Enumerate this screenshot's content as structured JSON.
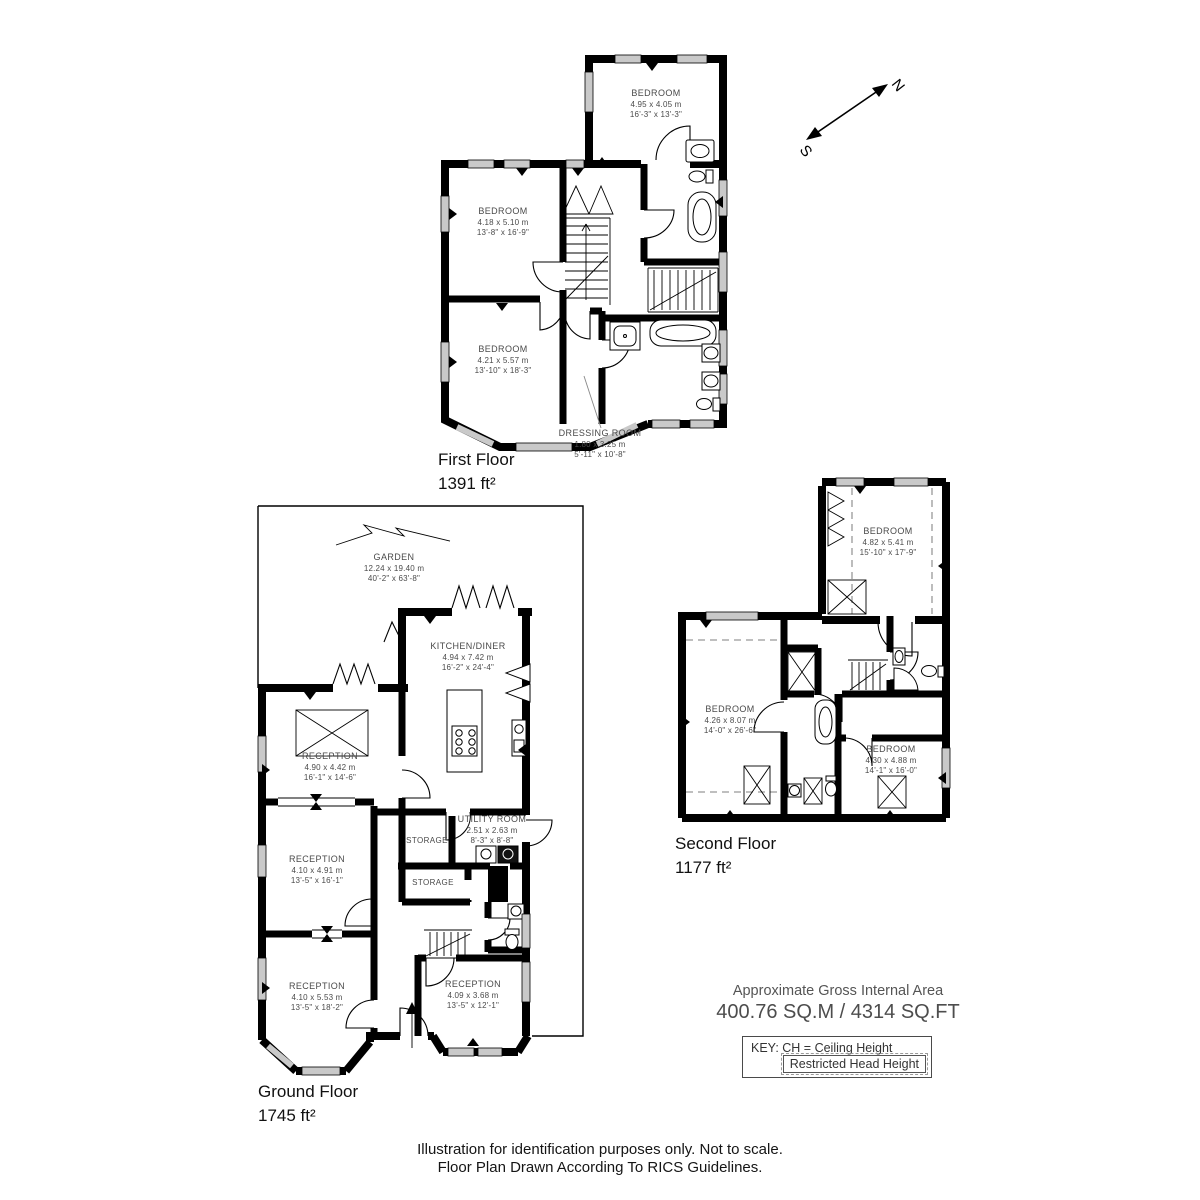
{
  "compass": {
    "north": "N",
    "south": "S"
  },
  "floors": {
    "first": {
      "title": "First Floor",
      "area": "1391 ft²",
      "rooms": {
        "bedroom_top": {
          "name": "BEDROOM",
          "metric": "4.95 x 4.05 m",
          "imperial": "16'-3\" x 13'-3\""
        },
        "bedroom_mid": {
          "name": "BEDROOM",
          "metric": "4.18 x 5.10 m",
          "imperial": "13'-8\" x 16'-9\""
        },
        "bedroom_bottom": {
          "name": "BEDROOM",
          "metric": "4.21 x 5.57 m",
          "imperial": "13'-10\" x 18'-3\""
        },
        "dressing_room": {
          "name": "DRESSING ROOM",
          "metric": "1.80 x 3.25 m",
          "imperial": "5'-11\" x 10'-8\""
        }
      }
    },
    "ground": {
      "title": "Ground Floor",
      "area": "1745 ft²",
      "rooms": {
        "garden": {
          "name": "GARDEN",
          "metric": "12.24 x 19.40 m",
          "imperial": "40'-2\" x 63'-8\""
        },
        "kitchen": {
          "name": "KITCHEN/DINER",
          "metric": "4.94 x 7.42 m",
          "imperial": "16'-2\" x 24'-4\""
        },
        "reception_rear": {
          "name": "RECEPTION",
          "metric": "4.90 x 4.42 m",
          "imperial": "16'-1\" x 14'-6\""
        },
        "utility": {
          "name": "UTILITY ROOM",
          "metric": "2.51 x 2.63 m",
          "imperial": "8'-3\" x 8'-8\""
        },
        "storage_upper": {
          "name": "STORAGE"
        },
        "reception_middle": {
          "name": "RECEPTION",
          "metric": "4.10 x 4.91 m",
          "imperial": "13'-5\" x 16'-1\""
        },
        "storage_lower": {
          "name": "STORAGE"
        },
        "reception_front_left": {
          "name": "RECEPTION",
          "metric": "4.10 x 5.53 m",
          "imperial": "13'-5\" x 18'-2\""
        },
        "reception_front_right": {
          "name": "RECEPTION",
          "metric": "4.09 x 3.68 m",
          "imperial": "13'-5\" x 12'-1\""
        }
      }
    },
    "second": {
      "title": "Second Floor",
      "area": "1177 ft²",
      "rooms": {
        "bedroom_top": {
          "name": "BEDROOM",
          "metric": "4.82 x 5.41 m",
          "imperial": "15'-10\" x 17'-9\""
        },
        "bedroom_left": {
          "name": "BEDROOM",
          "metric": "4.26 x 8.07 m",
          "imperial": "14'-0\" x 26'-6\""
        },
        "bedroom_right": {
          "name": "BEDROOM",
          "metric": "4.30 x 4.88 m",
          "imperial": "14'-1\" x 16'-0\""
        }
      }
    }
  },
  "summary": {
    "title": "Approximate Gross Internal Area",
    "value": "400.76 SQ.M / 4314 SQ.FT",
    "key": "KEY: CH = Ceiling Height",
    "restricted": "Restricted Head Height"
  },
  "disclaimer": {
    "line1": "Illustration for identification purposes only. Not to scale.",
    "line2": "Floor Plan Drawn According To RICS Guidelines."
  }
}
